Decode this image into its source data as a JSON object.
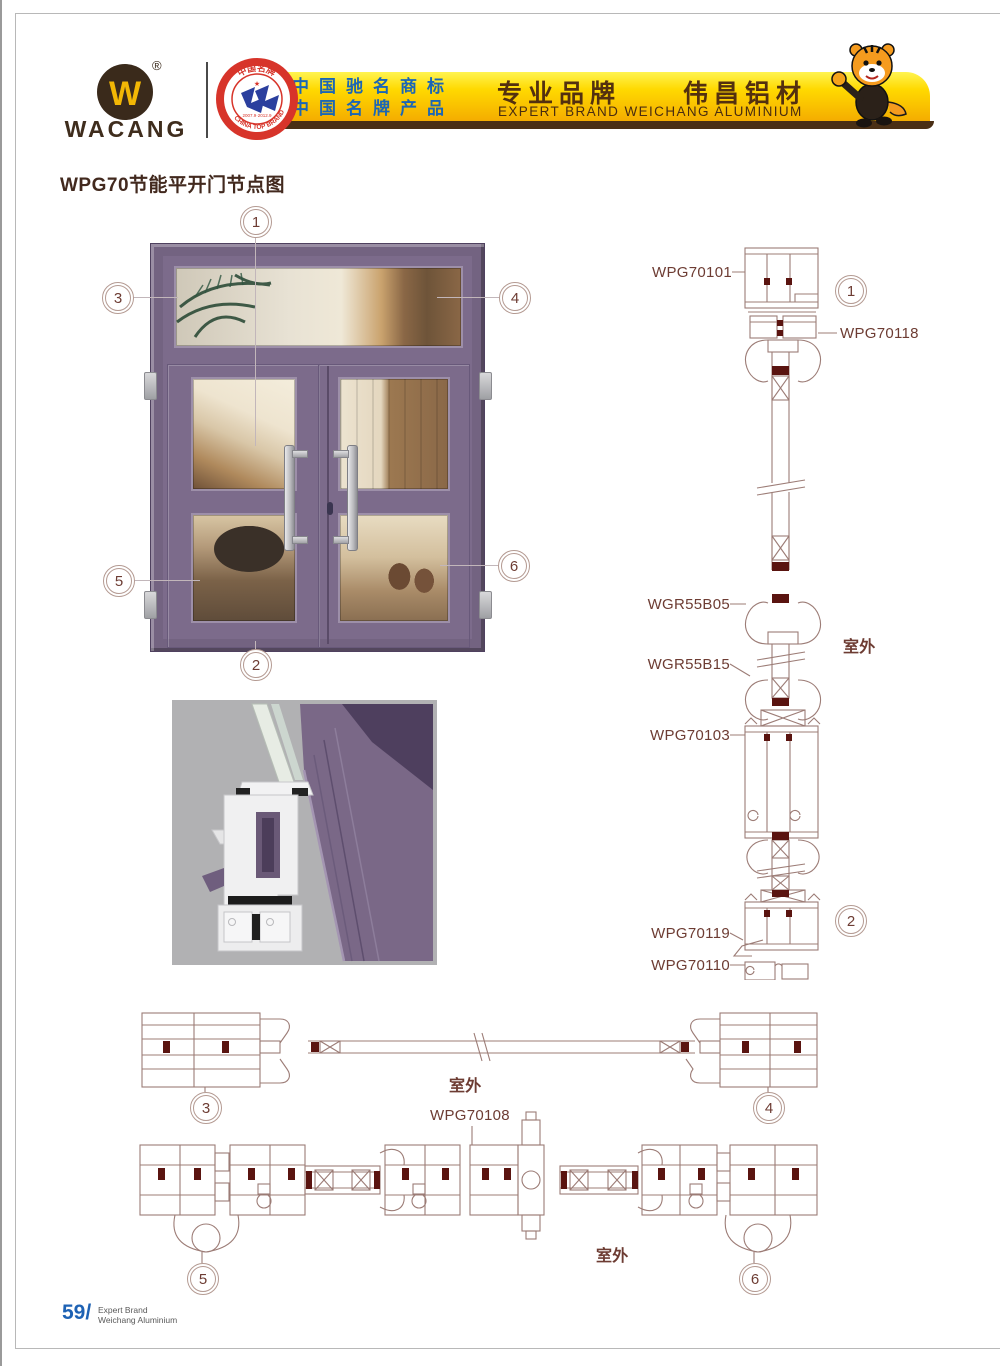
{
  "colors": {
    "banner_yellow": "#ffd900",
    "banner_brown": "#53300f",
    "banner_text_blue": "#1b66b5",
    "door_purple": "#7c6b8b",
    "drawing_line": "#9c7c76",
    "label_maroon": "#6d3c33",
    "footer_blue": "#1e62b4"
  },
  "header": {
    "brand": "WACANG",
    "registered_mark": "®",
    "logo_letter": "W",
    "seal": {
      "top_text": "中国名牌",
      "bottom_text": "CHINA TOP BRAND",
      "years": "2007.9·2012.9"
    },
    "banner": {
      "line1": "中国驰名商标",
      "line2": "中国名牌产品",
      "title": "专业品牌　　伟昌铝材",
      "subtitle": "EXPERT BRAND WEICHANG ALUMINIUM"
    }
  },
  "page_title": "WPG70节能平开门节点图",
  "callouts": {
    "n1": "1",
    "n2": "2",
    "n3": "3",
    "n4": "4",
    "n5": "5",
    "n6": "6"
  },
  "labels": {
    "wpg70101": "WPG70101",
    "wpg70118": "WPG70118",
    "wgr55b05": "WGR55B05",
    "wgr55b15": "WGR55B15",
    "wpg70103": "WPG70103",
    "wpg70119": "WPG70119",
    "wpg70110": "WPG70110",
    "wpg70108": "WPG70108",
    "outdoor_vertical": "室外",
    "outdoor_middle": "室外",
    "outdoor_bottom": "室外"
  },
  "footer": {
    "page_number": "59",
    "separator": "/",
    "brand_line1": "Expert Brand",
    "brand_line2": "Weichang Aluminium"
  }
}
